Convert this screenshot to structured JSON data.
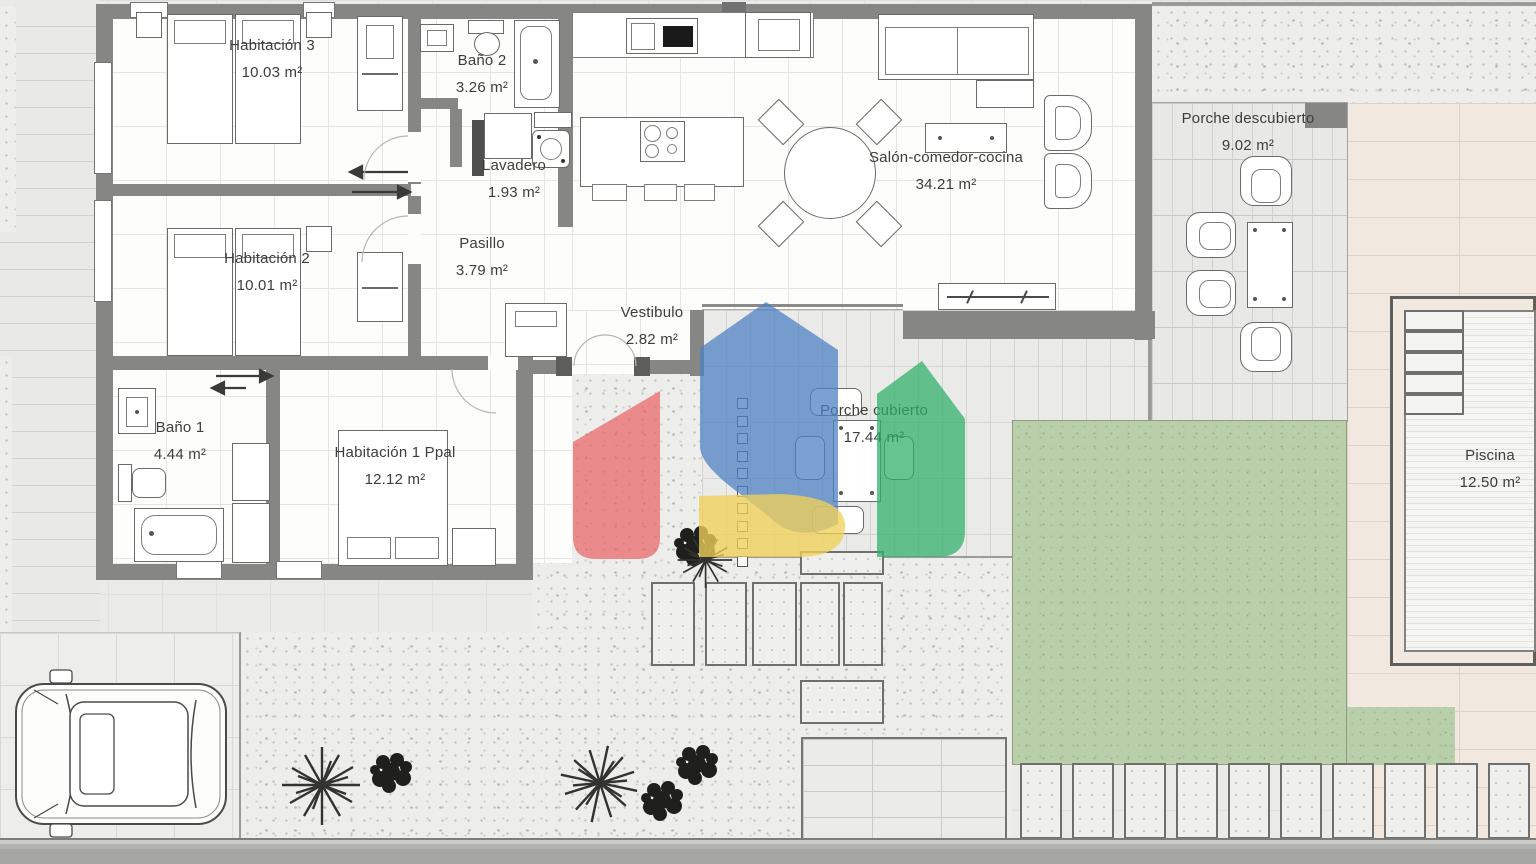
{
  "rooms": [
    {
      "id": "habitacion-3",
      "name": "Habitación 3",
      "area": "10.03 m²"
    },
    {
      "id": "bano-2",
      "name": "Baño 2",
      "area": "3.26 m²"
    },
    {
      "id": "lavadero",
      "name": "Lavadero",
      "area": "1.93 m²"
    },
    {
      "id": "habitacion-2",
      "name": "Habitación 2",
      "area": "10.01 m²"
    },
    {
      "id": "pasillo",
      "name": "Pasillo",
      "area": "3.79 m²"
    },
    {
      "id": "vestibulo",
      "name": "Vestibulo",
      "area": "2.82 m²"
    },
    {
      "id": "salon-comedor-cocina",
      "name": "Salón-comedor-cocina",
      "area": "34.21 m²"
    },
    {
      "id": "bano-1",
      "name": "Baño 1",
      "area": "4.44 m²"
    },
    {
      "id": "habitacion-1-ppal",
      "name": "Habitación 1 Ppal",
      "area": "12.12 m²"
    },
    {
      "id": "porche-cubierto",
      "name": "Porche cubierto",
      "area": "17.44 m²"
    },
    {
      "id": "porche-descubierto",
      "name": "Porche descubierto",
      "area": "9.02 m²"
    },
    {
      "id": "piscina",
      "name": "Piscina",
      "area": "12.50 m²"
    }
  ],
  "watermark": {
    "description": "house-shaped-logo-watermark",
    "colors": {
      "blue": "#4d80c4",
      "red": "#e85f63",
      "yellow": "#efd058",
      "green": "#2fb069"
    }
  }
}
